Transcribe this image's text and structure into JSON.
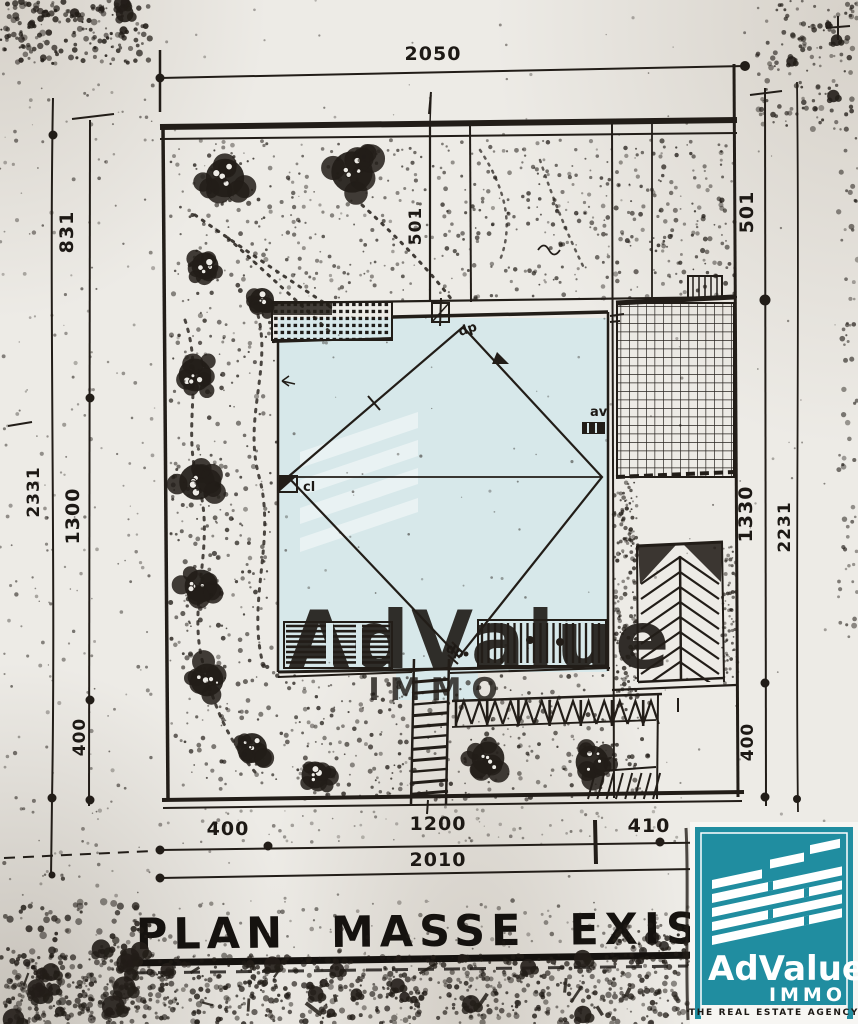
{
  "plan": {
    "title": "PLAN MASSE EXIST."
  },
  "dimensions": {
    "top_total": "2050",
    "left_outer": "2331",
    "left_top": "831",
    "left_mid": "1300",
    "left_bottom": "400",
    "right_outer": "2231",
    "right_top": "501",
    "right_mid": "1330",
    "right_bottom": "400",
    "inner_top": "501",
    "bottom_seg_left": "400",
    "bottom_seg_mid": "1200",
    "bottom_seg_right": "410",
    "bottom_total": "2010"
  },
  "labels": {
    "dp_top": "dp",
    "dp_bottom": "dp",
    "av": "av",
    "cl": "cl"
  },
  "watermark": {
    "name": "AdValue",
    "sub": "IMMO"
  },
  "logo": {
    "name": "AdValue",
    "division": "IMMO",
    "tagline": "THE REAL ESTATE AGENCY"
  },
  "colors": {
    "logo_teal": "#208da0",
    "watermark_blue": "#d7e8ea",
    "watermark_text": "#bcdae1",
    "ink": "#221d18",
    "paper": "#edebe6"
  }
}
